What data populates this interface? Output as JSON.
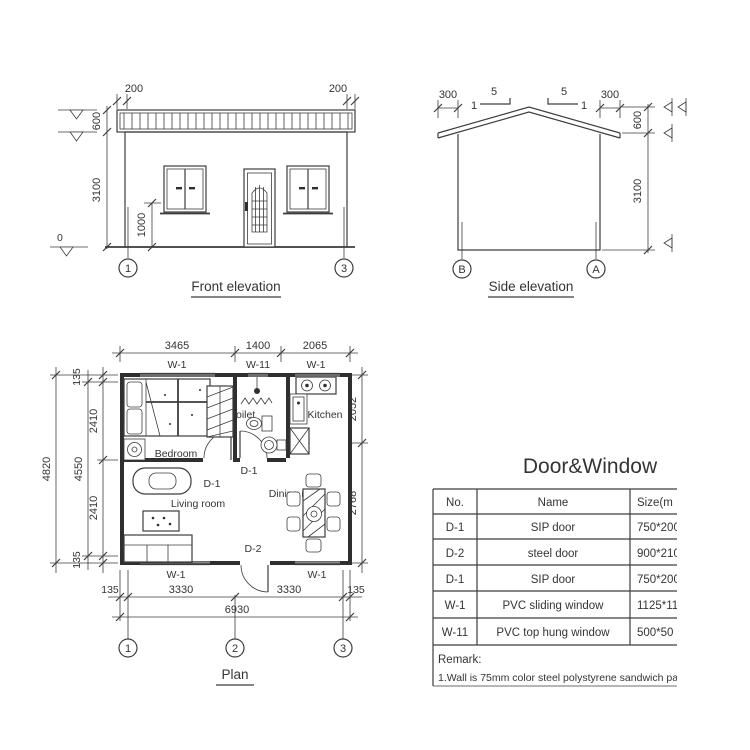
{
  "background": "#ffffff",
  "ink": "#3d3d3d",
  "front": {
    "title": "Front elevation",
    "dim_overhang_left": "200",
    "dim_overhang_right": "200",
    "dim_roof": "600",
    "dim_wall": "3100",
    "dim_sill": "1000",
    "level_zero": "0",
    "axis_left": "1",
    "axis_right": "3"
  },
  "side": {
    "title": "Side elevation",
    "dim_overhang_left": "300",
    "dim_overhang_right": "300",
    "dim_roof": "600",
    "dim_wall": "3100",
    "slope_run_left": "5",
    "slope_rise_left": "1",
    "slope_run_right": "5",
    "slope_rise_right": "1",
    "axis_left": "B",
    "axis_right": "A"
  },
  "plan": {
    "title": "Plan",
    "dim_top_1": "3465",
    "dim_top_2": "1400",
    "dim_top_3": "2065",
    "win_top_1": "W-1",
    "win_top_2": "W-11",
    "win_top_3": "W-1",
    "win_bottom_1": "W-1",
    "win_bottom_2": "W-1",
    "dim_left_135_top": "135",
    "dim_left_2410_top": "2410",
    "dim_left_2410_bottom": "2410",
    "dim_left_135_bottom": "135",
    "dim_left_4550": "4550",
    "dim_left_4820": "4820",
    "dim_right_2052": "2052",
    "dim_right_2768": "2768",
    "dim_bottom_135_left": "135",
    "dim_bottom_3330_left": "3330",
    "dim_bottom_3330_right": "3330",
    "dim_bottom_135_right": "135",
    "dim_bottom_total": "6930",
    "room_bedroom": "Bedroom",
    "room_toilet": "Toilet",
    "room_kitchen": "Kitchen",
    "room_living": "Living room",
    "room_dining": "Dining room",
    "door_d1_bedroom": "D-1",
    "door_d1_toilet": "D-1",
    "door_d2": "D-2",
    "axis_1": "1",
    "axis_2": "2",
    "axis_3": "3"
  },
  "schedule": {
    "title": "Door&Window",
    "col_no": "No.",
    "col_name": "Name",
    "col_size": "Size(m",
    "rows": [
      {
        "no": "D-1",
        "name": "SIP door",
        "size": "750*200"
      },
      {
        "no": "D-2",
        "name": "steel door",
        "size": "900*210"
      },
      {
        "no": "D-1",
        "name": "SIP door",
        "size": "750*200"
      },
      {
        "no": "W-1",
        "name": "PVC sliding window",
        "size": "1125*11"
      },
      {
        "no": "W-11",
        "name": "PVC top hung window",
        "size": "500*50"
      }
    ],
    "remark_title": "Remark:",
    "remark_1": "1.Wall is 75mm color steel polystyrene sandwich pane"
  }
}
